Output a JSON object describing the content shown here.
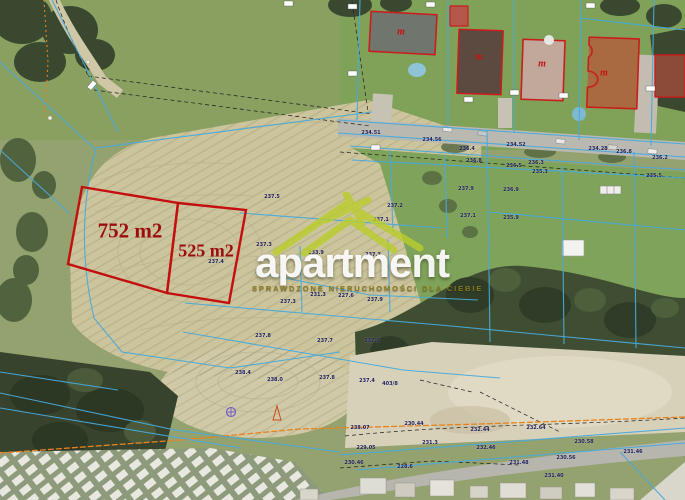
{
  "watermark": {
    "brand": "apartment",
    "tagline": "SPRAWDZONE NIERUCHOMOŚCI DLA CIEBIE"
  },
  "plots": [
    {
      "label": "752 m2",
      "area_m2": 752
    },
    {
      "label": "525 m2",
      "area_m2": 525
    }
  ],
  "building_markers": [
    {
      "x": 401,
      "y": 32,
      "t": "m"
    },
    {
      "x": 479,
      "y": 57,
      "t": "m"
    },
    {
      "x": 542,
      "y": 64,
      "t": "m"
    },
    {
      "x": 604,
      "y": 73,
      "t": "m"
    }
  ],
  "elevation_labels": [
    {
      "x": 272,
      "y": 197,
      "t": "237.5"
    },
    {
      "x": 395,
      "y": 206,
      "t": "237.2"
    },
    {
      "x": 381,
      "y": 220,
      "t": "237.1"
    },
    {
      "x": 264,
      "y": 245,
      "t": "237.3"
    },
    {
      "x": 316,
      "y": 253,
      "t": "233.9"
    },
    {
      "x": 373,
      "y": 255,
      "t": "237.3"
    },
    {
      "x": 318,
      "y": 295,
      "t": "231.3"
    },
    {
      "x": 346,
      "y": 296,
      "t": "227.6"
    },
    {
      "x": 216,
      "y": 262,
      "t": "237.4"
    },
    {
      "x": 288,
      "y": 302,
      "t": "237.3"
    },
    {
      "x": 375,
      "y": 300,
      "t": "237.9"
    },
    {
      "x": 263,
      "y": 336,
      "t": "237.8"
    },
    {
      "x": 325,
      "y": 341,
      "t": "237.7"
    },
    {
      "x": 372,
      "y": 341,
      "t": "237.3"
    },
    {
      "x": 275,
      "y": 380,
      "t": "238.0"
    },
    {
      "x": 327,
      "y": 378,
      "t": "237.8"
    },
    {
      "x": 367,
      "y": 381,
      "t": "237.4"
    },
    {
      "x": 243,
      "y": 373,
      "t": "238.4"
    },
    {
      "x": 390,
      "y": 384,
      "t": "403/8"
    },
    {
      "x": 467,
      "y": 149,
      "t": "236.4"
    },
    {
      "x": 474,
      "y": 161,
      "t": "236.8"
    },
    {
      "x": 536,
      "y": 163,
      "t": "236.3"
    },
    {
      "x": 540,
      "y": 172,
      "t": "235.3"
    },
    {
      "x": 514,
      "y": 166,
      "t": "236.5"
    },
    {
      "x": 466,
      "y": 189,
      "t": "237.9"
    },
    {
      "x": 511,
      "y": 190,
      "t": "236.9"
    },
    {
      "x": 511,
      "y": 218,
      "t": "235.9"
    },
    {
      "x": 468,
      "y": 216,
      "t": "237.1"
    },
    {
      "x": 654,
      "y": 176,
      "t": "235.5"
    },
    {
      "x": 660,
      "y": 158,
      "t": "236.2"
    },
    {
      "x": 624,
      "y": 152,
      "t": "236.8"
    },
    {
      "x": 371,
      "y": 133,
      "t": "234.51"
    },
    {
      "x": 432,
      "y": 140,
      "t": "234.56"
    },
    {
      "x": 516,
      "y": 145,
      "t": "234.52"
    },
    {
      "x": 598,
      "y": 149,
      "t": "234.28"
    },
    {
      "x": 360,
      "y": 428,
      "t": "238.07"
    },
    {
      "x": 414,
      "y": 424,
      "t": "230.44"
    },
    {
      "x": 480,
      "y": 430,
      "t": "232.44"
    },
    {
      "x": 536,
      "y": 428,
      "t": "232.64"
    },
    {
      "x": 430,
      "y": 443,
      "t": "231.3"
    },
    {
      "x": 366,
      "y": 448,
      "t": "229.05"
    },
    {
      "x": 486,
      "y": 448,
      "t": "232.46"
    },
    {
      "x": 566,
      "y": 458,
      "t": "230.56"
    },
    {
      "x": 519,
      "y": 463,
      "t": "231.48"
    },
    {
      "x": 554,
      "y": 476,
      "t": "231.40"
    },
    {
      "x": 354,
      "y": 463,
      "t": "230.46"
    },
    {
      "x": 405,
      "y": 467,
      "t": "228.6"
    },
    {
      "x": 633,
      "y": 452,
      "t": "231.46"
    },
    {
      "x": 584,
      "y": 442,
      "t": "230.58"
    }
  ],
  "colors": {
    "plot_outline": "#c40f0f",
    "plot_label_text": "#9c0d0d",
    "cadastral_line": "#49aadb",
    "watermark_green": "#b9cd2f",
    "elevation_text": "#1d1d5a",
    "utility_orange": "#e6831e"
  }
}
